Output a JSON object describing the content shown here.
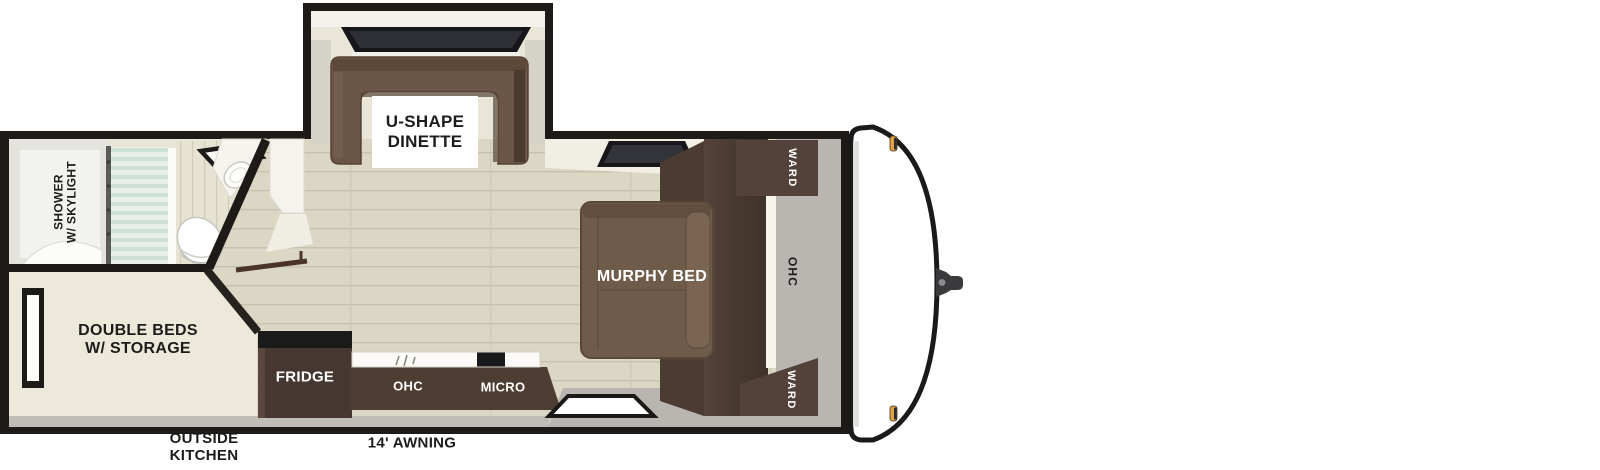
{
  "diagram_type": "travel trailer floorplan",
  "labels": {
    "dinette": {
      "line1": "U-SHAPE",
      "line2": "DINETTE"
    },
    "shower": {
      "line1": "SHOWER",
      "line2": "W/ SKYLIGHT"
    },
    "double_beds": {
      "line1": "DOUBLE BEDS",
      "line2": "W/ STORAGE"
    },
    "fridge": "FRIDGE",
    "kitchen_ohc": "OHC",
    "micro": "MICRO",
    "murphy_bed": "MURPHY BED",
    "ward_top": "WARD",
    "front_ohc": "OHC",
    "ward_bottom": "WARD",
    "outside_kitchen": {
      "line1": "OUTSIDE",
      "line2": "KITCHEN"
    },
    "awning": "14' AWNING"
  },
  "colors": {
    "wall": "#1d1a17",
    "dark_wood": "#4c3c33",
    "sofa_brown": "#6a5546",
    "floor_wood": "#dcd7c5",
    "floor_cream": "#ece8d9",
    "floor_gray": "#b9b6b1",
    "glass": "#d8e6dc",
    "marker_light": "#e2a445",
    "text_dark": "#1d1c1a",
    "text_light": "#ffffff"
  }
}
